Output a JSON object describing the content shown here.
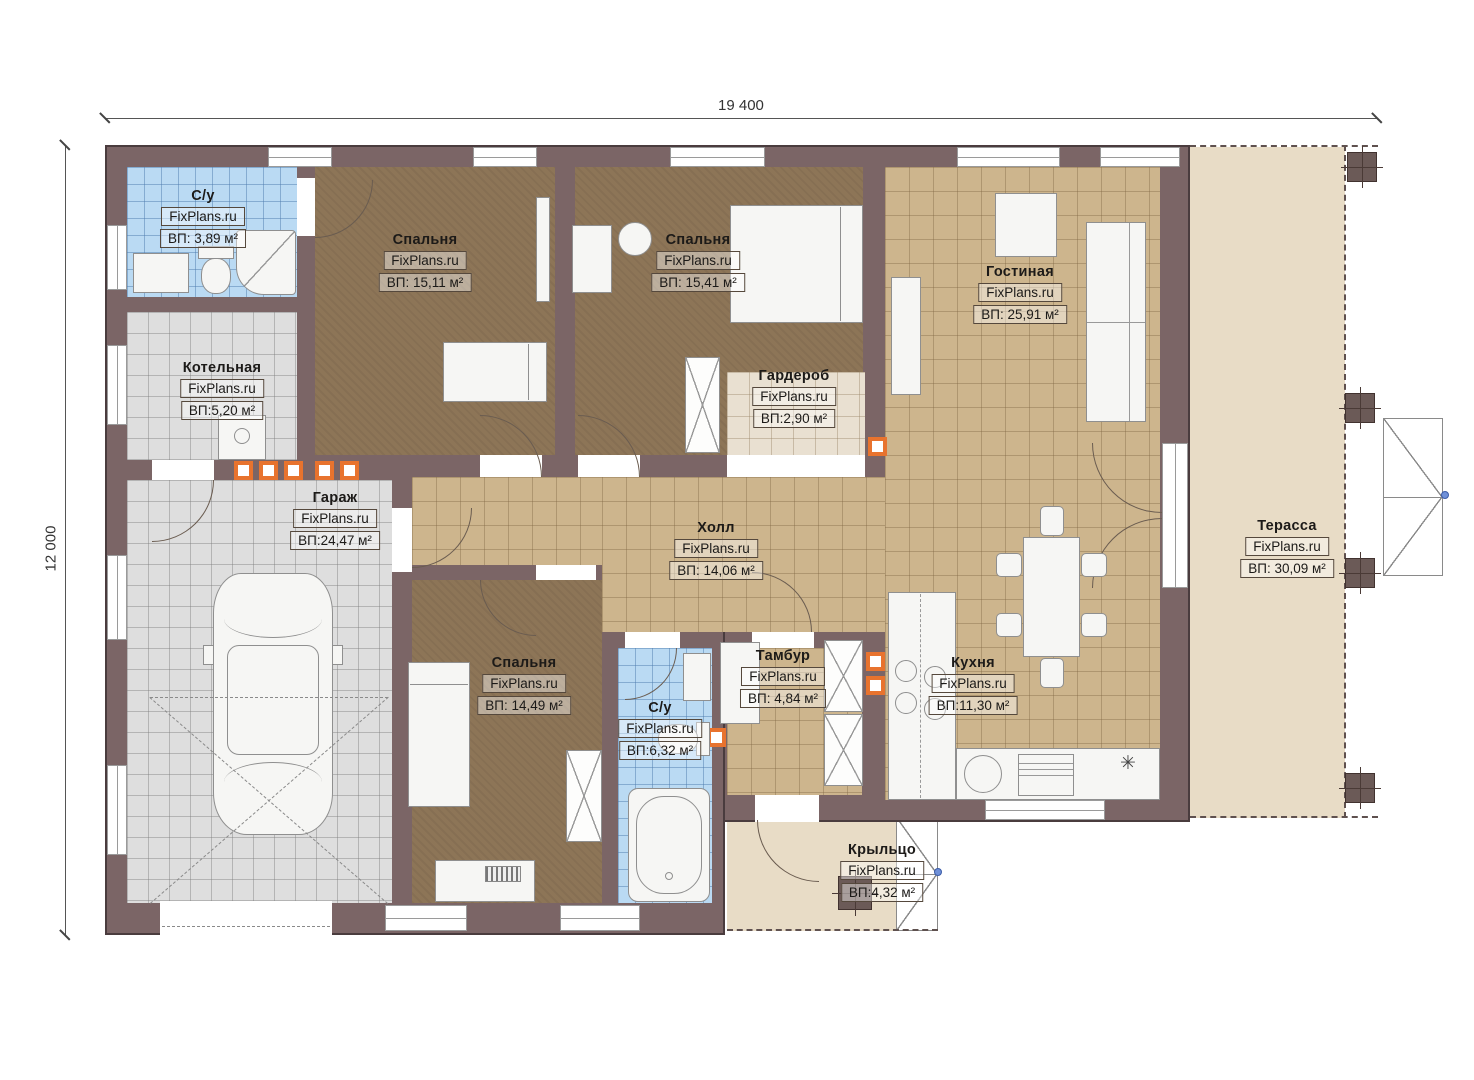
{
  "dims": {
    "width_label": "19 400",
    "height_label": "12 000"
  },
  "brand": "FixPlans.ru",
  "symbols": {
    "kitchen_star": "✳"
  },
  "colors": {
    "wall": "#7b6566",
    "floor_tan": "#cdb58d",
    "floor_brown": "#8d7557",
    "floor_blue": "#badaf3",
    "floor_gray": "#dedede",
    "terrace": "#e8dcc6",
    "marker_orange": "#e8732e"
  },
  "rooms": [
    {
      "id": "bath1",
      "name": "С/у",
      "brand": "FixPlans.ru",
      "area": "ВП: 3,89 м²"
    },
    {
      "id": "bedroom1",
      "name": "Спальня",
      "brand": "FixPlans.ru",
      "area": "ВП: 15,11 м²"
    },
    {
      "id": "bedroom2",
      "name": "Спальня",
      "brand": "FixPlans.ru",
      "area": "ВП: 15,41 м²"
    },
    {
      "id": "wardrobe",
      "name": "Гардероб",
      "brand": "FixPlans.ru",
      "area": "ВП:2,90 м²"
    },
    {
      "id": "living",
      "name": "Гостиная",
      "brand": "FixPlans.ru",
      "area": "ВП: 25,91 м²"
    },
    {
      "id": "boiler",
      "name": "Котельная",
      "brand": "FixPlans.ru",
      "area": "ВП:5,20 м²"
    },
    {
      "id": "garage",
      "name": "Гараж",
      "brand": "FixPlans.ru",
      "area": "ВП:24,47 м²"
    },
    {
      "id": "hall",
      "name": "Холл",
      "brand": "FixPlans.ru",
      "area": "ВП: 14,06 м²"
    },
    {
      "id": "bedroom3",
      "name": "Спальня",
      "brand": "FixPlans.ru",
      "area": "ВП: 14,49 м²"
    },
    {
      "id": "bath2",
      "name": "С/у",
      "brand": "FixPlans.ru",
      "area": "ВП:6,32 м²"
    },
    {
      "id": "tambur",
      "name": "Тамбур",
      "brand": "FixPlans.ru",
      "area": "ВП: 4,84 м²"
    },
    {
      "id": "kitchen",
      "name": "Кухня",
      "brand": "FixPlans.ru",
      "area": "ВП:11,30 м²"
    },
    {
      "id": "terrace",
      "name": "Терасса",
      "brand": "FixPlans.ru",
      "area": "ВП: 30,09 м²"
    },
    {
      "id": "porch",
      "name": "Крыльцо",
      "brand": "FixPlans.ru",
      "area": "ВП:4,32 м²"
    }
  ]
}
